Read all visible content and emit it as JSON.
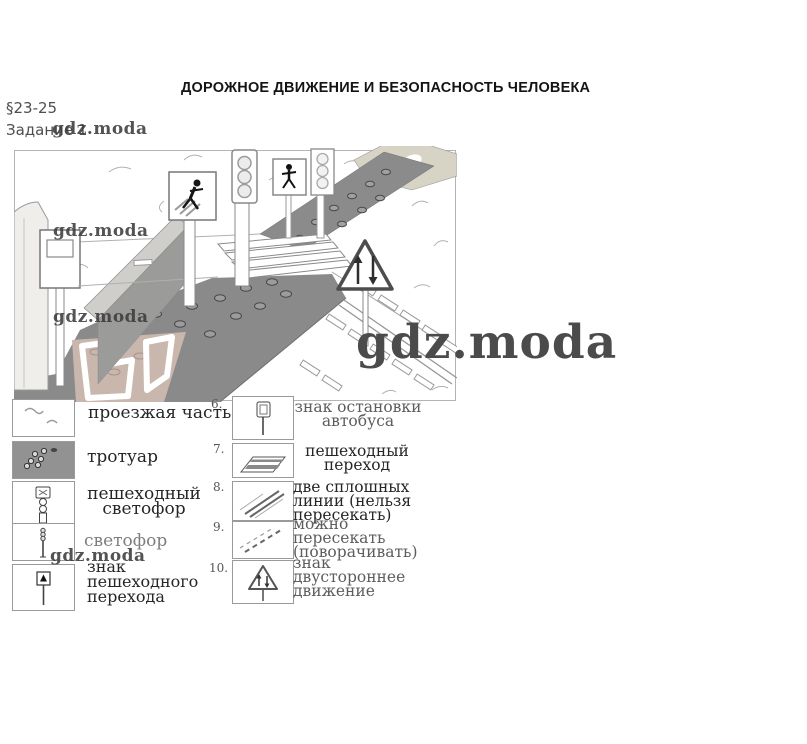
{
  "header": {
    "title": "ДОРОЖНОЕ ДВИЖЕНИЕ И БЕЗОПАСНОСТЬ ЧЕЛОВЕКА",
    "section": "§23-25",
    "task": "Задание 1"
  },
  "watermark": {
    "text": "gdz.moda"
  },
  "legend": {
    "left": [
      {
        "icon": "roadway-swatch",
        "label": "проезжая часть"
      },
      {
        "icon": "sidewalk-swatch",
        "label": "тротуар"
      },
      {
        "icon": "pedestrian-signal-icon",
        "label": "пешеходный\nсветофор"
      },
      {
        "icon": "traffic-light-icon",
        "label": "светофор"
      },
      {
        "icon": "crosswalk-sign-icon",
        "label": "знак\nпешеходного\nперехода"
      }
    ],
    "right": [
      {
        "num": "6.",
        "icon": "bus-stop-sign-icon",
        "label": "знак остановки\nавтобуса"
      },
      {
        "num": "7.",
        "icon": "crosswalk-icon",
        "label": "пешеходный\nпереход"
      },
      {
        "num": "8.",
        "icon": "double-solid-line-icon",
        "label": "две сплошных\nлинии (нельзя\nпересекать)"
      },
      {
        "num": "9.",
        "icon": "dashed-line-icon",
        "label": "можно\nпересекать\n(поворачивать)"
      },
      {
        "num": "10.",
        "icon": "two-way-traffic-sign-icon",
        "label": "знак\nдвустороннее\nдвижение"
      }
    ]
  }
}
